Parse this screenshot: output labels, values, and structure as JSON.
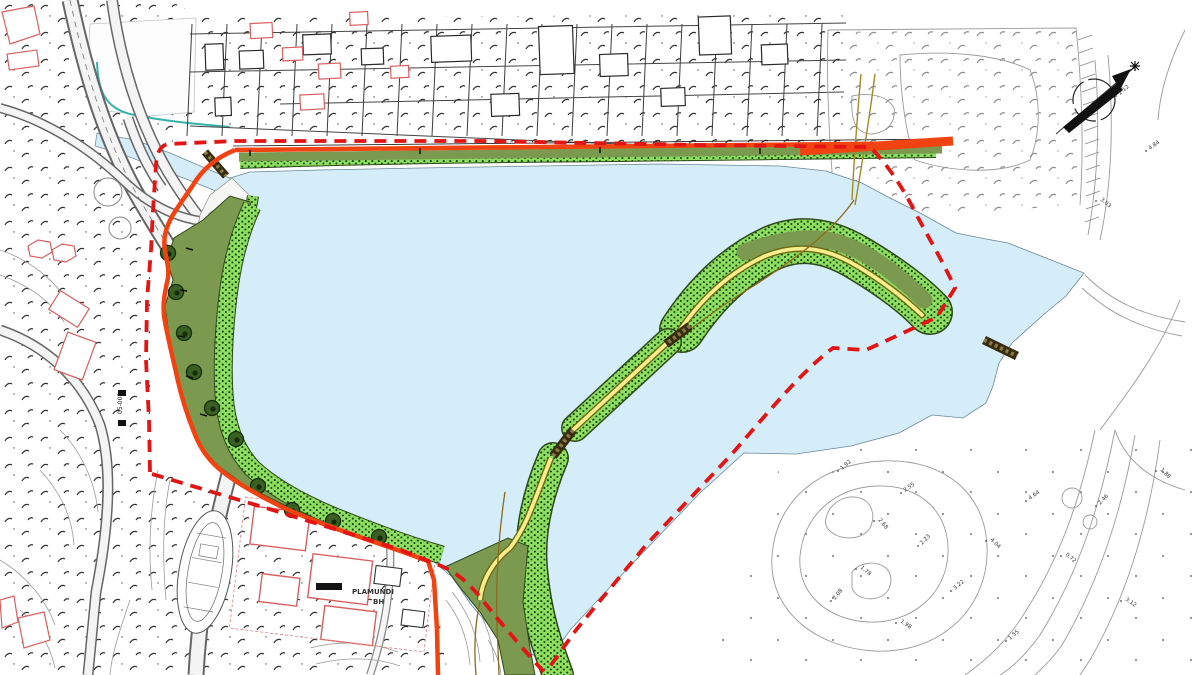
{
  "map": {
    "type": "urban-planning-site-plan",
    "labels": {
      "parcel_name_line1": "PLAMUNDI",
      "parcel_name_line2": "BH",
      "road_code": "05-008"
    },
    "colors": {
      "water": "#d5edf8",
      "green_dark": "#7b9a50",
      "green_light": "#8ede5f",
      "green_dot": "#17430f",
      "tree_green": "#3a5f22",
      "promenade_red": "#f14311",
      "boundary_red": "#e31414",
      "path_yellow": "#f6ee8d",
      "path_casing": "#6f6716",
      "trail_olive": "#a38a26",
      "pier_brown": "#372c10",
      "canal_teal": "#35b3ab",
      "building_red": "#d95f5f",
      "linework": "#3c3c3c",
      "linework_light": "#9a9a9a"
    },
    "north_arrow": {
      "symbol": "compass-northeast"
    },
    "trees": [
      {
        "x": 168,
        "y": 253
      },
      {
        "x": 176,
        "y": 292
      },
      {
        "x": 184,
        "y": 333
      },
      {
        "x": 194,
        "y": 372
      },
      {
        "x": 212,
        "y": 408
      },
      {
        "x": 236,
        "y": 439
      },
      {
        "x": 258,
        "y": 486
      },
      {
        "x": 292,
        "y": 510
      },
      {
        "x": 333,
        "y": 521
      },
      {
        "x": 379,
        "y": 537
      }
    ],
    "spot_heights": [
      {
        "v": "1.92",
        "x": 842,
        "y": 470,
        "r": -40
      },
      {
        "v": "2.55",
        "x": 905,
        "y": 492,
        "r": -35
      },
      {
        "v": "2.68",
        "x": 878,
        "y": 520,
        "r": 50
      },
      {
        "v": "2.23",
        "x": 922,
        "y": 545,
        "r": -45
      },
      {
        "v": "1.78",
        "x": 860,
        "y": 568,
        "r": 40
      },
      {
        "v": "2.08",
        "x": 835,
        "y": 600,
        "r": -50
      },
      {
        "v": "1.98",
        "x": 900,
        "y": 622,
        "r": 35
      },
      {
        "v": "3.22",
        "x": 955,
        "y": 590,
        "r": -40
      },
      {
        "v": "4.04",
        "x": 990,
        "y": 540,
        "r": 45
      },
      {
        "v": "4.64",
        "x": 1030,
        "y": 500,
        "r": -35
      },
      {
        "v": "0.72",
        "x": 1065,
        "y": 555,
        "r": 40
      },
      {
        "v": "2.46",
        "x": 1100,
        "y": 505,
        "r": -45
      },
      {
        "v": "3.12",
        "x": 1125,
        "y": 600,
        "r": 35
      },
      {
        "v": "1.55",
        "x": 1010,
        "y": 640,
        "r": -40
      },
      {
        "v": "4.84",
        "x": 1150,
        "y": 150,
        "r": -35
      },
      {
        "v": "3.03",
        "x": 1100,
        "y": 200,
        "r": 40
      },
      {
        "v": "2.12",
        "x": 1120,
        "y": 95,
        "r": -40
      },
      {
        "v": "1.88",
        "x": 1160,
        "y": 470,
        "r": 45
      }
    ]
  }
}
